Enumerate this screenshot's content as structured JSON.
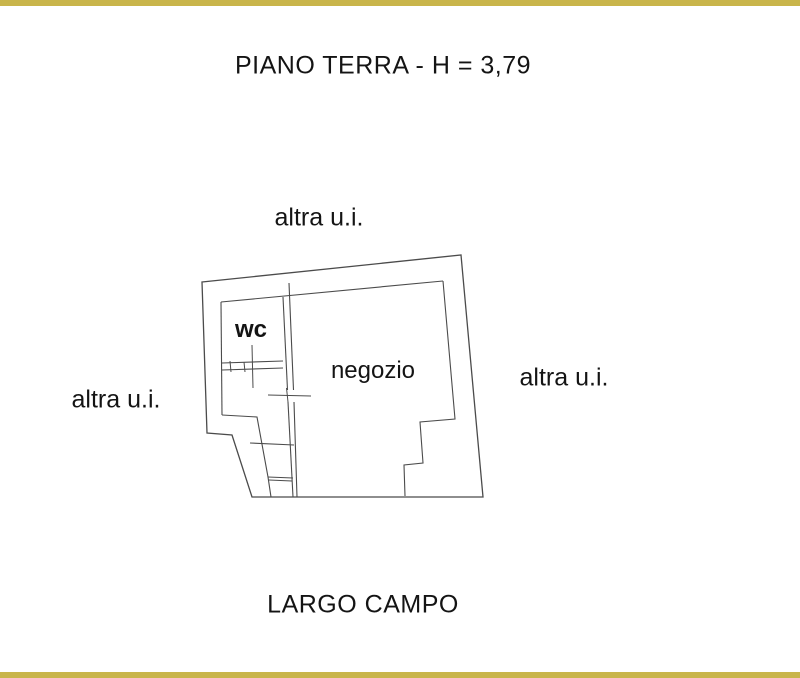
{
  "title": "PIANO TERRA - H = 3,79",
  "plan_labels": {
    "wc": "wc",
    "shop": "negozio"
  },
  "adjacent_units": {
    "top": "altra u.i.",
    "left": "altra u.i.",
    "right": "altra u.i."
  },
  "street_name": "LARGO CAMPO",
  "colors": {
    "background": "#ffffff",
    "wall_line": "#4b4b4b",
    "text": "#141414",
    "frame_bar": "#c9b54b"
  }
}
